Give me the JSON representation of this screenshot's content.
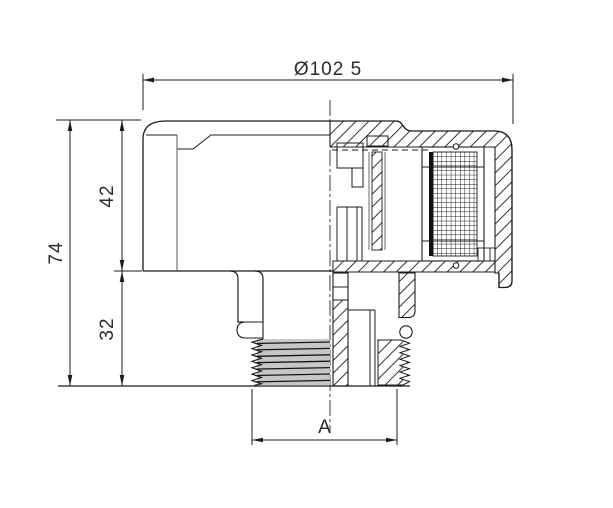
{
  "drawing": {
    "type": "technical-section-drawing",
    "background": "#ffffff",
    "line_color": "#1c1c1c",
    "thread_shade": "#c6c6c6",
    "dimensions": {
      "diameter_top": "Ø102 5",
      "height_overall": "74",
      "height_upper": "42",
      "height_lower": "32",
      "width_thread": "A"
    }
  }
}
